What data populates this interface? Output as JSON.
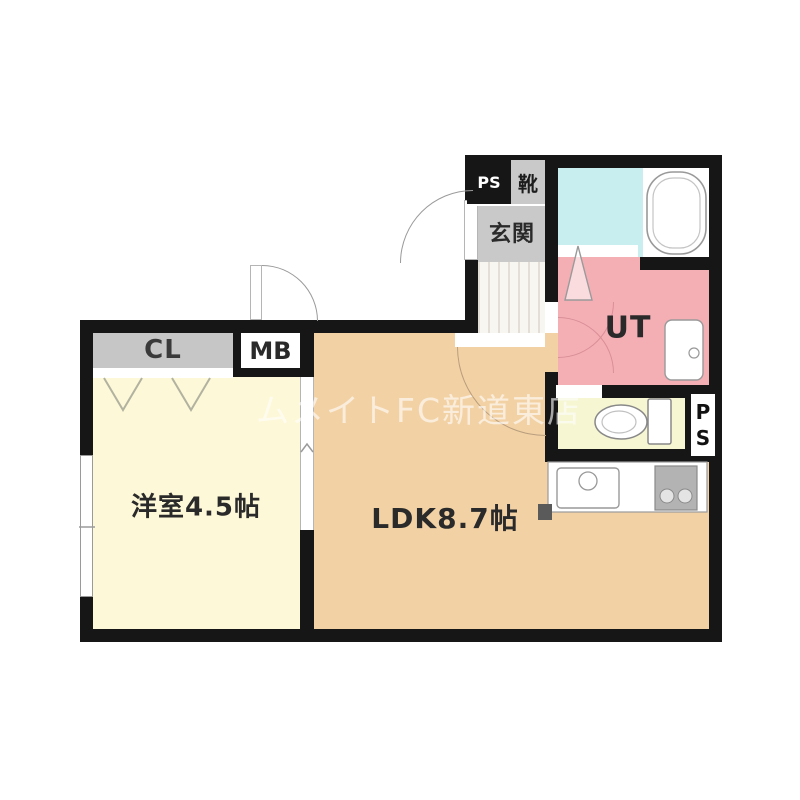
{
  "watermark": "ムメイトFC新道東店",
  "rooms": {
    "western": {
      "label": "洋室4.5帖"
    },
    "ldk": {
      "label": "LDK8.7帖"
    },
    "entrance": {
      "label": "玄関"
    },
    "shoe_cabinet": {
      "label": "靴"
    },
    "utility": {
      "label": "UT"
    },
    "closet": {
      "label": "CL"
    },
    "meter_box": {
      "label": "MB"
    },
    "pipe_space_top": {
      "label": "PS"
    },
    "pipe_space_right": {
      "p": "P",
      "s": "S"
    }
  },
  "colors": {
    "wall": "#161616",
    "ldk_floor": "#f2d2a5",
    "western_floor": "#fdf8d7",
    "toilet_floor": "#f6f6d2",
    "utility_floor": "#f4afb5",
    "bath_floor": "#c9eef0",
    "entrance_floor": "#c9c9c9",
    "closet_fill": "#c6c6c6",
    "fixture_stroke": "#999999",
    "watermark_text": "#ffffff"
  }
}
